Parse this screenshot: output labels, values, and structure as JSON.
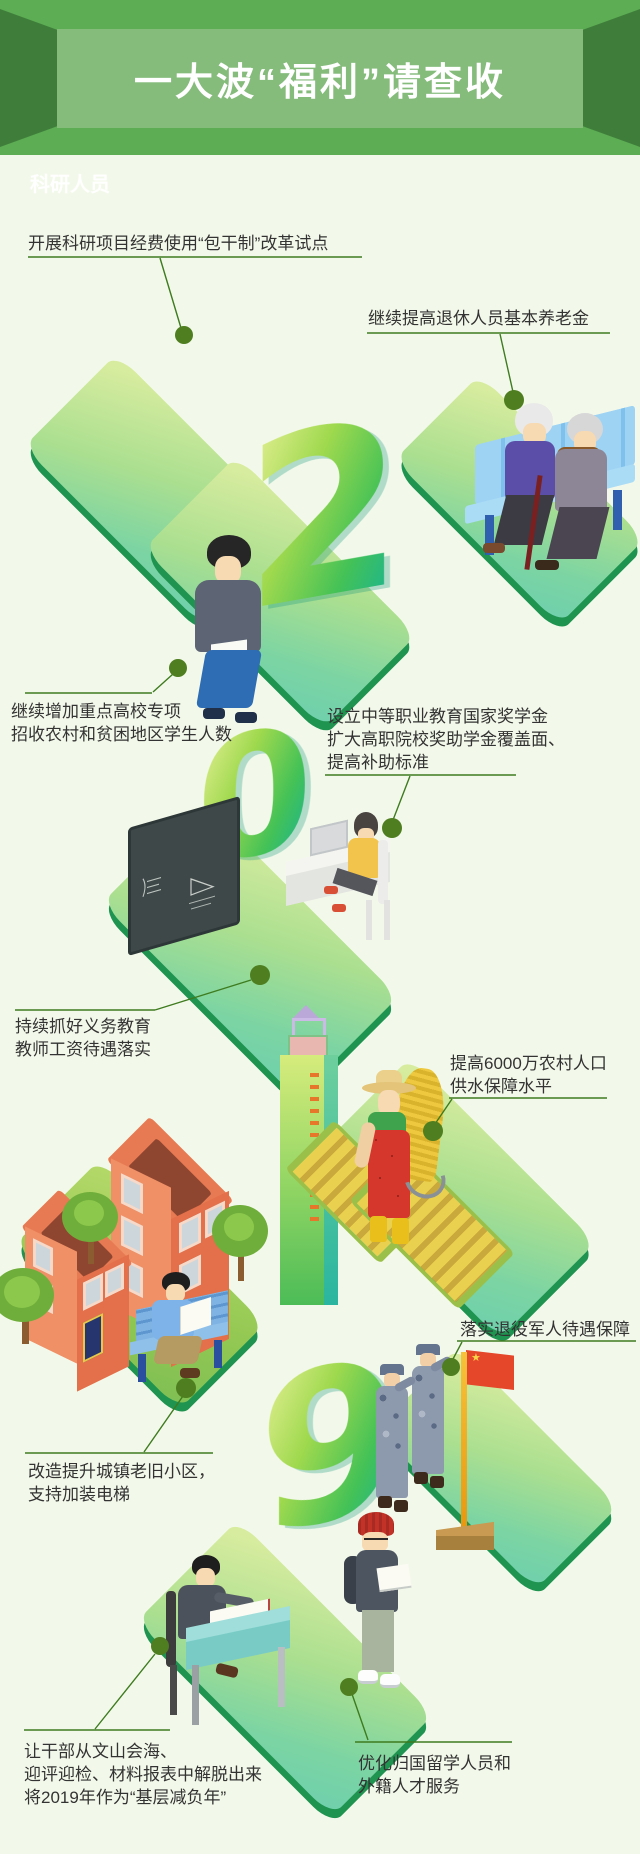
{
  "banner": {
    "title": "一大波“福利”请查收",
    "bg_color": "#5cad53",
    "side_color": "#3f7d3b",
    "panel_color": "#85bb7b",
    "text_color": "#ffffff"
  },
  "watermark": "科研人员",
  "year": {
    "digits": [
      "2",
      "0",
      "1",
      "9"
    ]
  },
  "flag": {
    "star": "★",
    "color": "#e5472b"
  },
  "colors": {
    "background": "#f3f9ea",
    "annotation_text": "#333333",
    "connector_line": "#3e7b1f",
    "dot": "#4e7e1f",
    "platform_rim": "#1f9350",
    "digit_gradient": [
      "#e9f199",
      "#9fd94e",
      "#45c256",
      "#12b29b"
    ]
  },
  "annotations": [
    {
      "id": "research",
      "lines": [
        "开展科研项目经费使用“包干制”改革试点"
      ]
    },
    {
      "id": "pension",
      "lines": [
        "继续提高退休人员基本养老金"
      ]
    },
    {
      "id": "enrollment",
      "lines": [
        "继续增加重点高校专项",
        "招收农村和贫困地区学生人数"
      ]
    },
    {
      "id": "scholarship",
      "lines": [
        "设立中等职业教育国家奖学金",
        "扩大高职院校奖助学金覆盖面、",
        "提高补助标准"
      ]
    },
    {
      "id": "teacher",
      "lines": [
        "持续抓好义务教育",
        "教师工资待遇落实"
      ]
    },
    {
      "id": "water",
      "lines": [
        "提高6000万农村人口",
        "供水保障水平"
      ]
    },
    {
      "id": "renovation",
      "lines": [
        "改造提升城镇老旧小区，",
        "支持加装电梯"
      ]
    },
    {
      "id": "veterans",
      "lines": [
        "落实退役军人待遇保障"
      ]
    },
    {
      "id": "burden",
      "lines": [
        "让干部从文山会海、",
        "迎评迎检、材料报表中解脱出来",
        "将2019年作为“基层减负年”"
      ]
    },
    {
      "id": "talent",
      "lines": [
        "优化归国留学人员和",
        "外籍人才服务"
      ]
    }
  ]
}
